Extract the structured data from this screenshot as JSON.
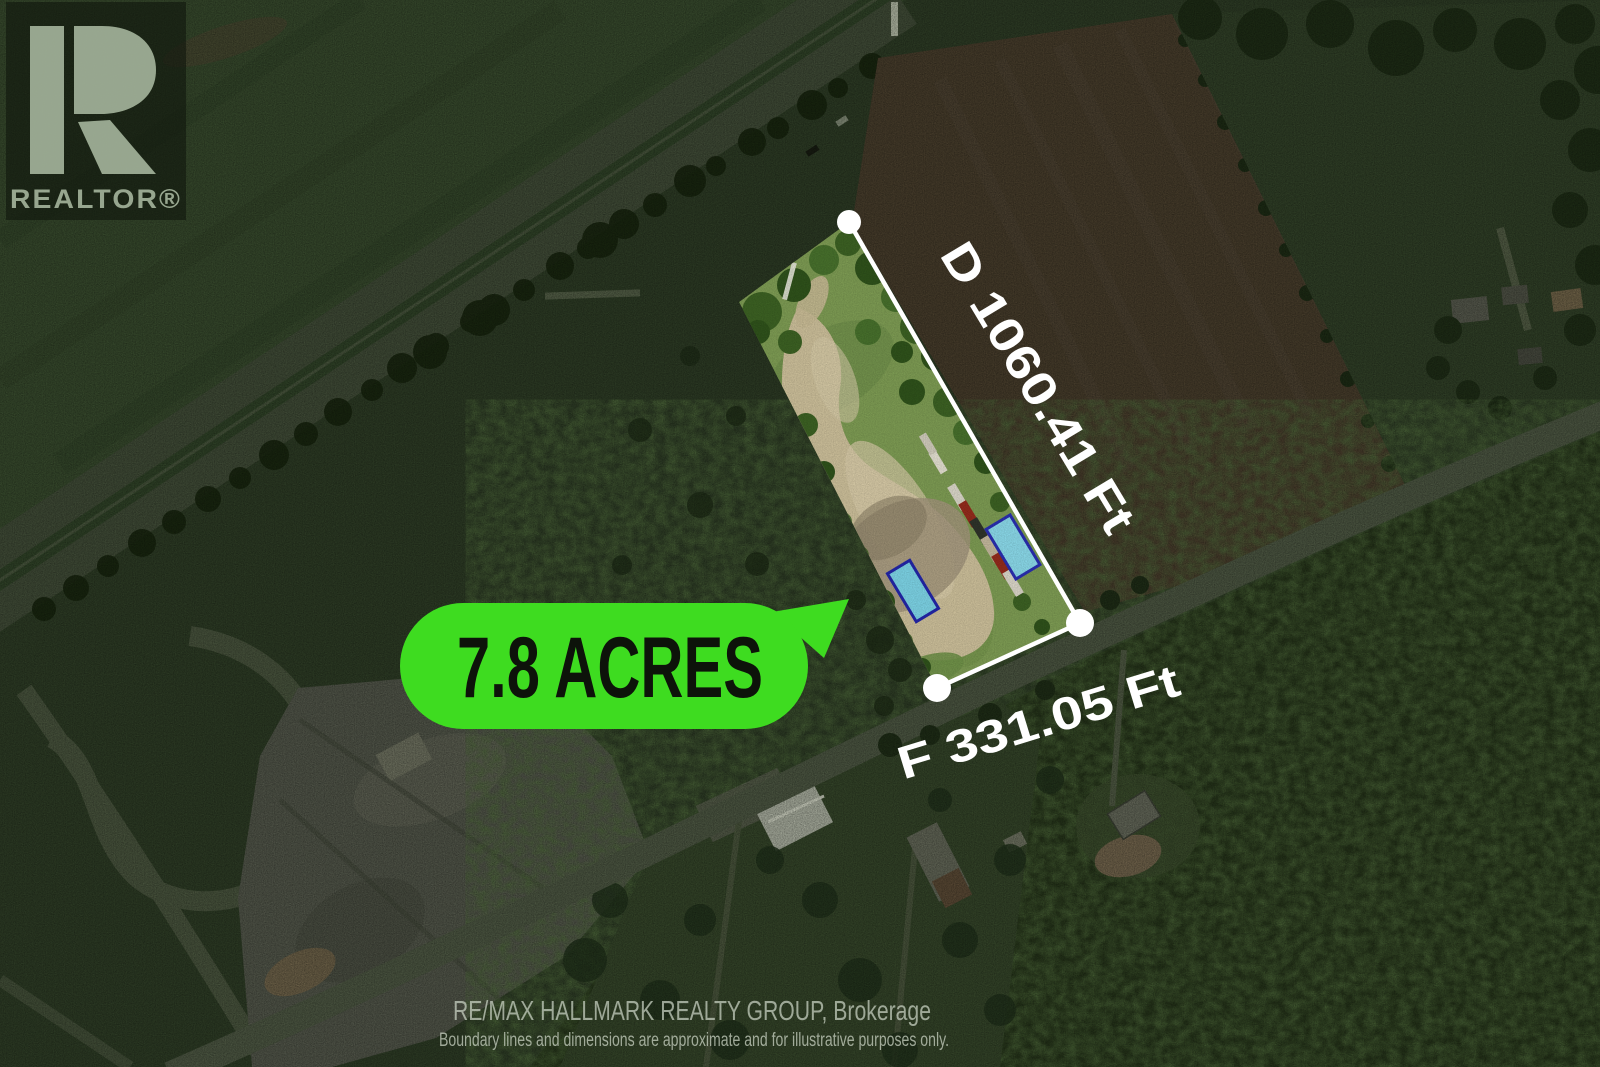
{
  "watermark": {
    "wordmark": "REALTOR®"
  },
  "annotations": {
    "area_callout": "7.8 ACRES",
    "dimension_d": "D 1060.41 Ft",
    "dimension_f": "F 331.05 Ft"
  },
  "footer": {
    "brokerage": "RE/MAX HALLMARK REALTY GROUP, Brokerage",
    "disclaimer": "Boundary lines and dimensions are approximate and for illustrative purposes only."
  },
  "colors": {
    "callout_bg": "#3edc20",
    "callout_text": "#0d130a",
    "dimension_text": "#ffffff",
    "boundary_line": "#ffffff",
    "corner_marker": "#ffffff",
    "footer_text": "#ccd5c6",
    "disclaimer_text": "#c4cdbd",
    "watermark_glyph": "#a9b9a0",
    "parcel_grass": "#7d9b53",
    "parcel_sand": "#cbbe99",
    "blue_roof": "#7cd2e4"
  }
}
